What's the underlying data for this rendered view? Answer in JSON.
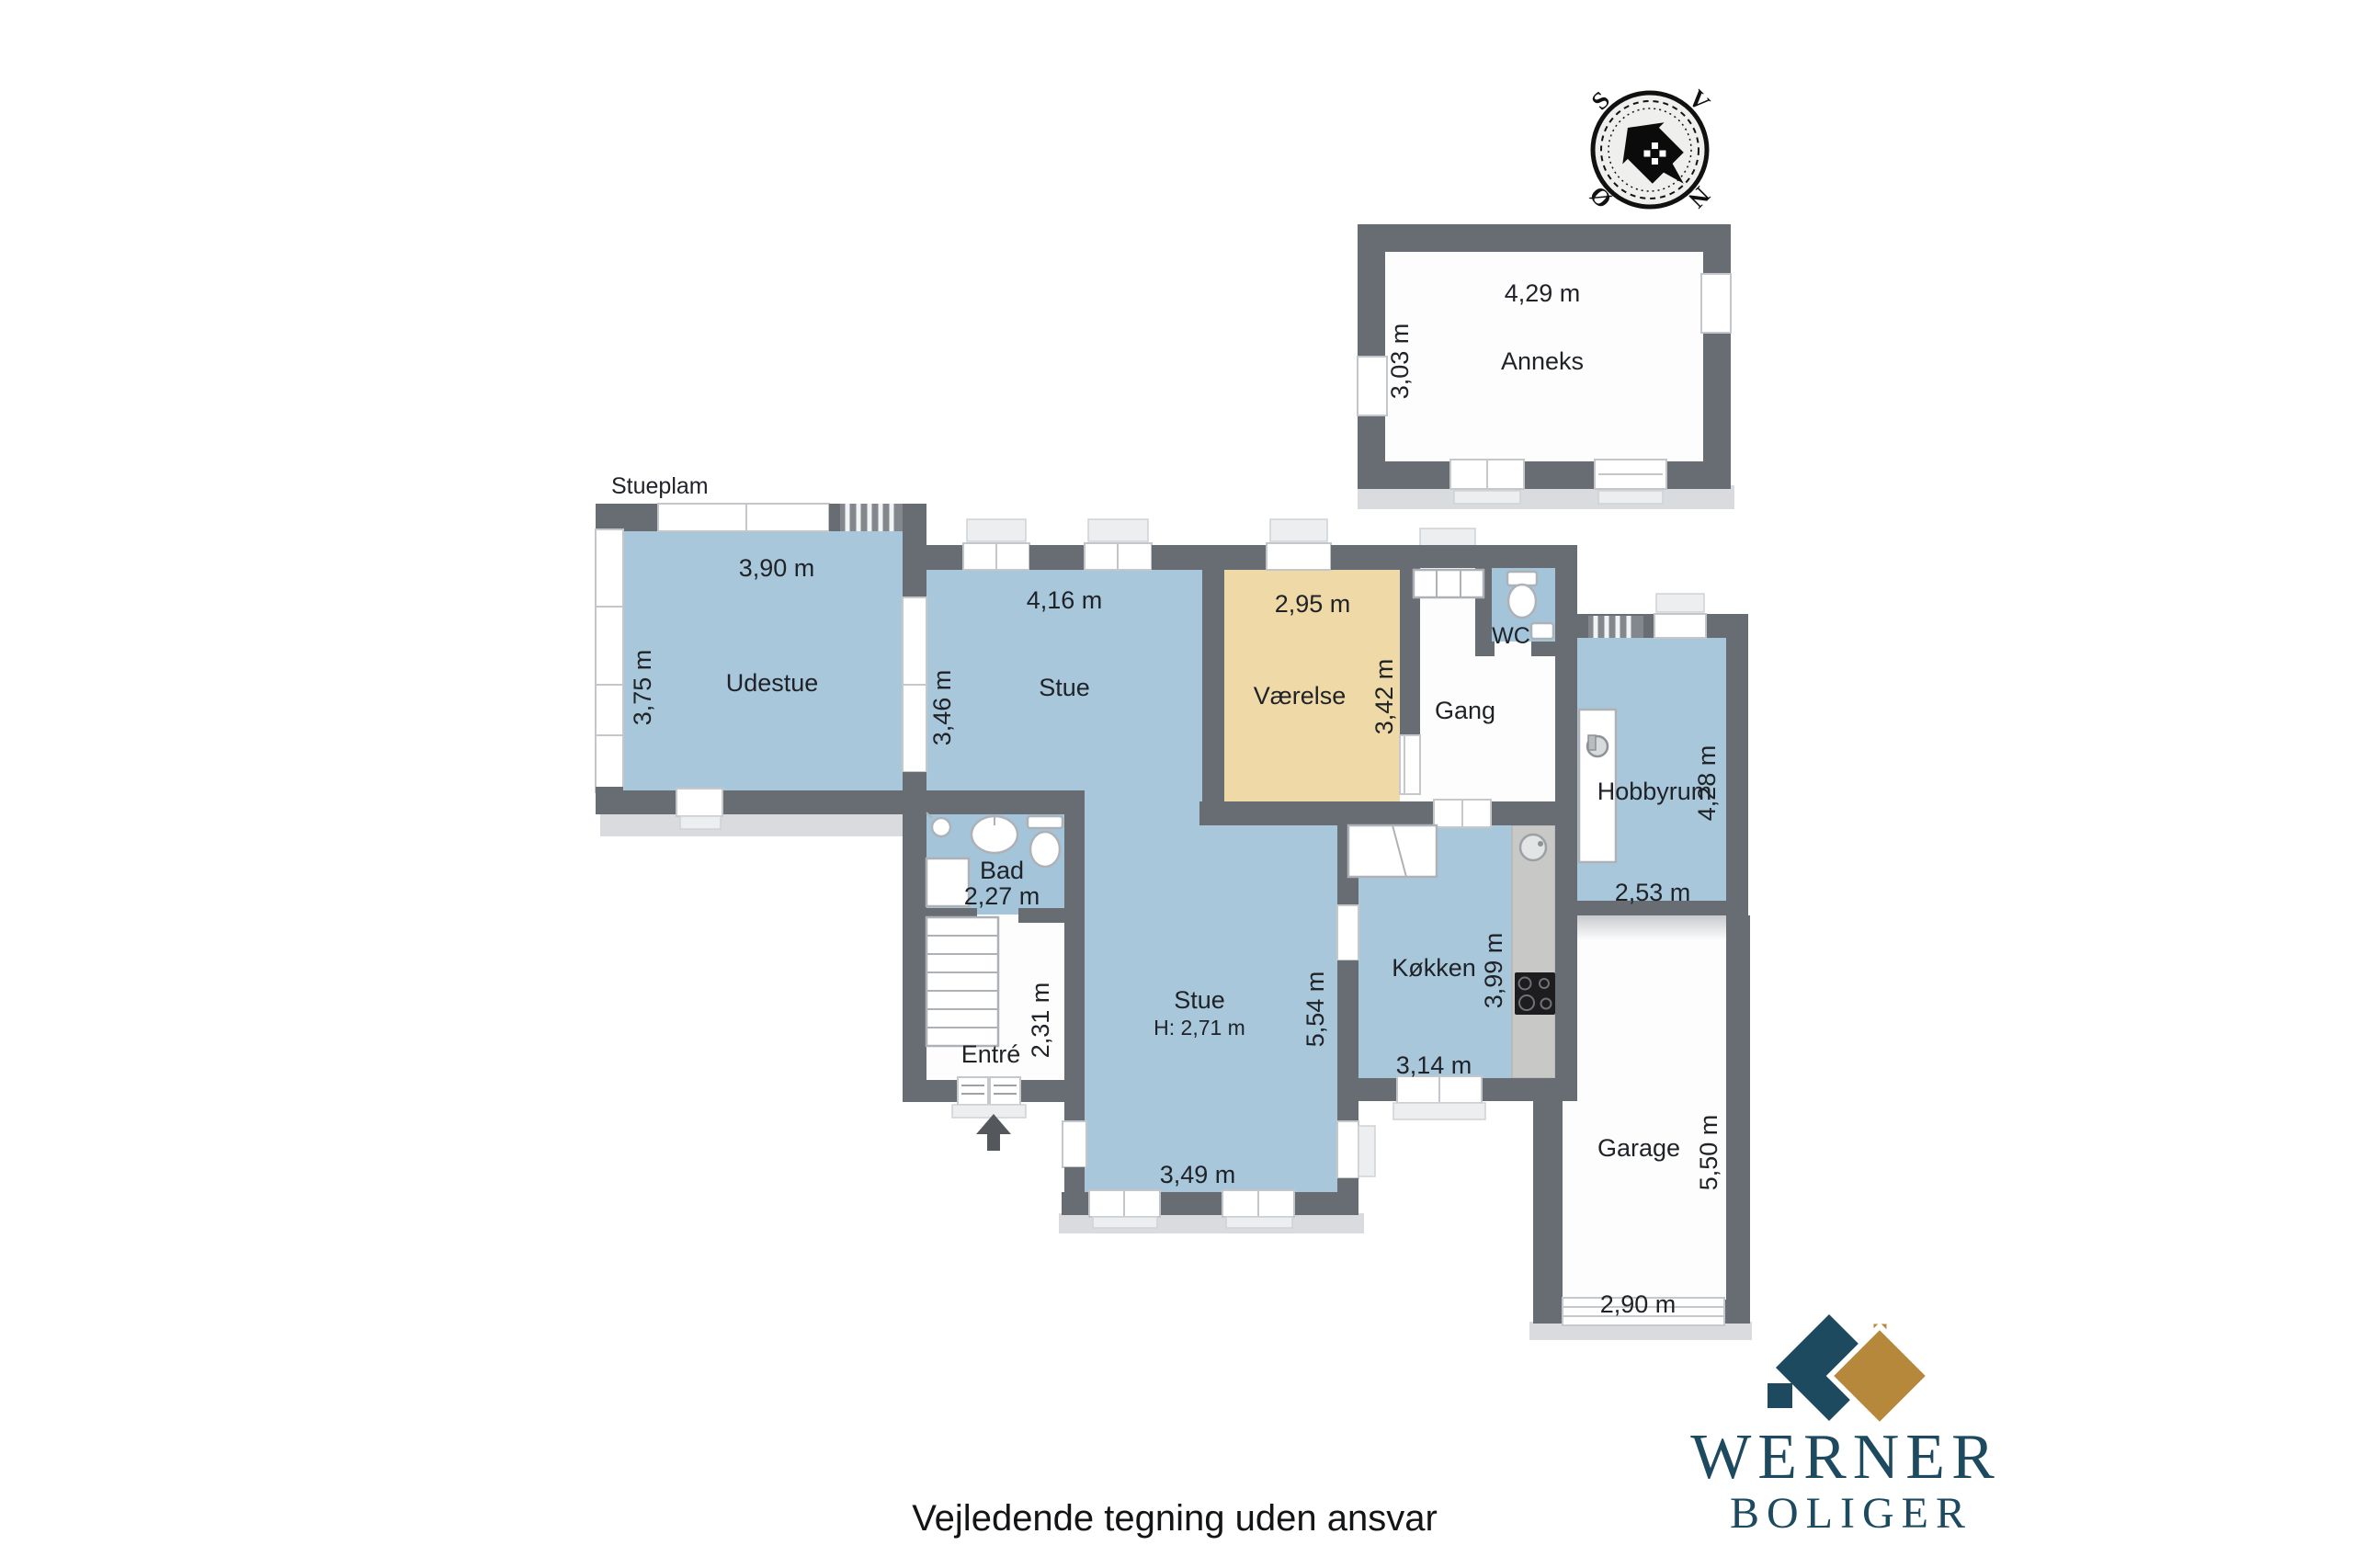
{
  "page": {
    "plan_label": "Stueplam",
    "disclaimer": "Vejledende tegning uden ansvar"
  },
  "compass": {
    "n": "N",
    "s": "S",
    "east": "Ø",
    "west": "V"
  },
  "logo": {
    "name": "WERNER",
    "subtitle": "BOLIGER"
  },
  "colors": {
    "wall": "#686c73",
    "floor_blue": "#a9c7db",
    "floor_tan": "#eed9a7",
    "outdoor_gray": "#d9dbdf",
    "logo_navy": "#1d4a5f",
    "logo_gold": "#b5883c"
  },
  "rooms": {
    "anneks": {
      "name": "Anneks",
      "width": "4,29 m",
      "depth": "3,03 m"
    },
    "udestue": {
      "name": "Udestue",
      "width": "3,90 m",
      "depth": "3,75 m"
    },
    "stue": {
      "name": "Stue",
      "width": "4,16 m",
      "depth": "3,46 m"
    },
    "vaerelse": {
      "name": "Værelse",
      "width": "2,95 m",
      "depth": "3,42 m"
    },
    "wc": {
      "name": "WC"
    },
    "gang": {
      "name": "Gang"
    },
    "hobbyrum": {
      "name": "Hobbyrum",
      "width": "2,53 m",
      "depth": "4,28 m"
    },
    "bad": {
      "name": "Bad",
      "width": "2,27 m"
    },
    "entre": {
      "name": "Entré",
      "depth": "2,31 m"
    },
    "stue2": {
      "name": "Stue",
      "ceiling": "H: 2,71 m",
      "width": "3,49 m",
      "depth": "5,54 m"
    },
    "koekken": {
      "name": "Køkken",
      "width": "3,14 m",
      "depth": "3,99 m"
    },
    "garage": {
      "name": "Garage",
      "width": "2,90 m",
      "depth": "5,50 m"
    }
  }
}
